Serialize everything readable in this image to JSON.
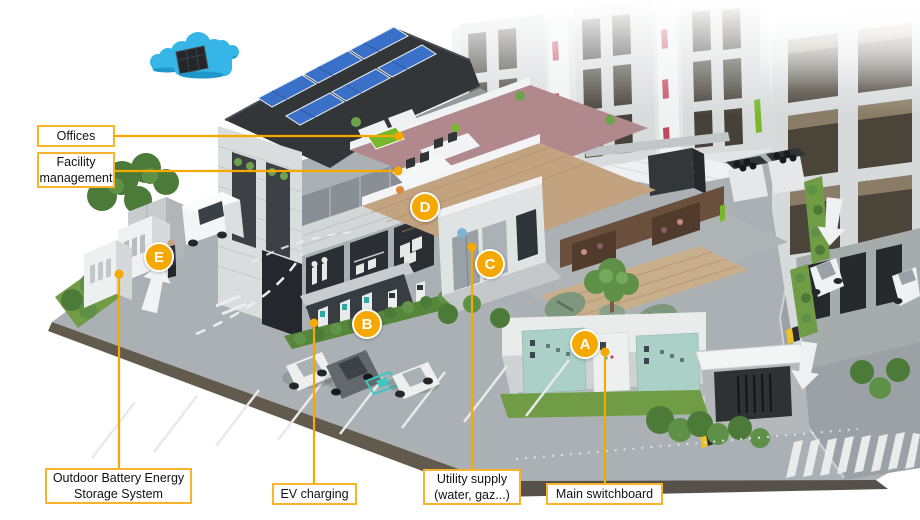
{
  "callouts": {
    "offices": {
      "label": "Offices"
    },
    "facility_management": {
      "label": "Facility\nmanagement"
    },
    "outdoor_battery": {
      "label": "Outdoor Battery Energy\nStorage System"
    },
    "ev_charging": {
      "label": "EV charging"
    },
    "utility_supply": {
      "label": "Utility supply\n(water, gaz...)"
    },
    "main_switchboard": {
      "label": "Main switchboard"
    }
  },
  "markers": {
    "a": "A",
    "b": "B",
    "c": "C",
    "d": "D",
    "e": "E"
  },
  "icons": {
    "cloud_solar": "cloud-solar-icon",
    "arrow_up_road": "road-arrow-up-icon",
    "arrow_down_road": "road-arrow-down-icon"
  },
  "colors": {
    "accent_yellow": "#F5A800",
    "callout_border": "#F6B52D",
    "marker_letter": "#FFFFFF",
    "cloud_blue": "#35B6E6",
    "solar_panel_blue": "#3B70C9",
    "grass_green": "#6F9C44",
    "switchboard_teal": "#ABD0C8"
  }
}
